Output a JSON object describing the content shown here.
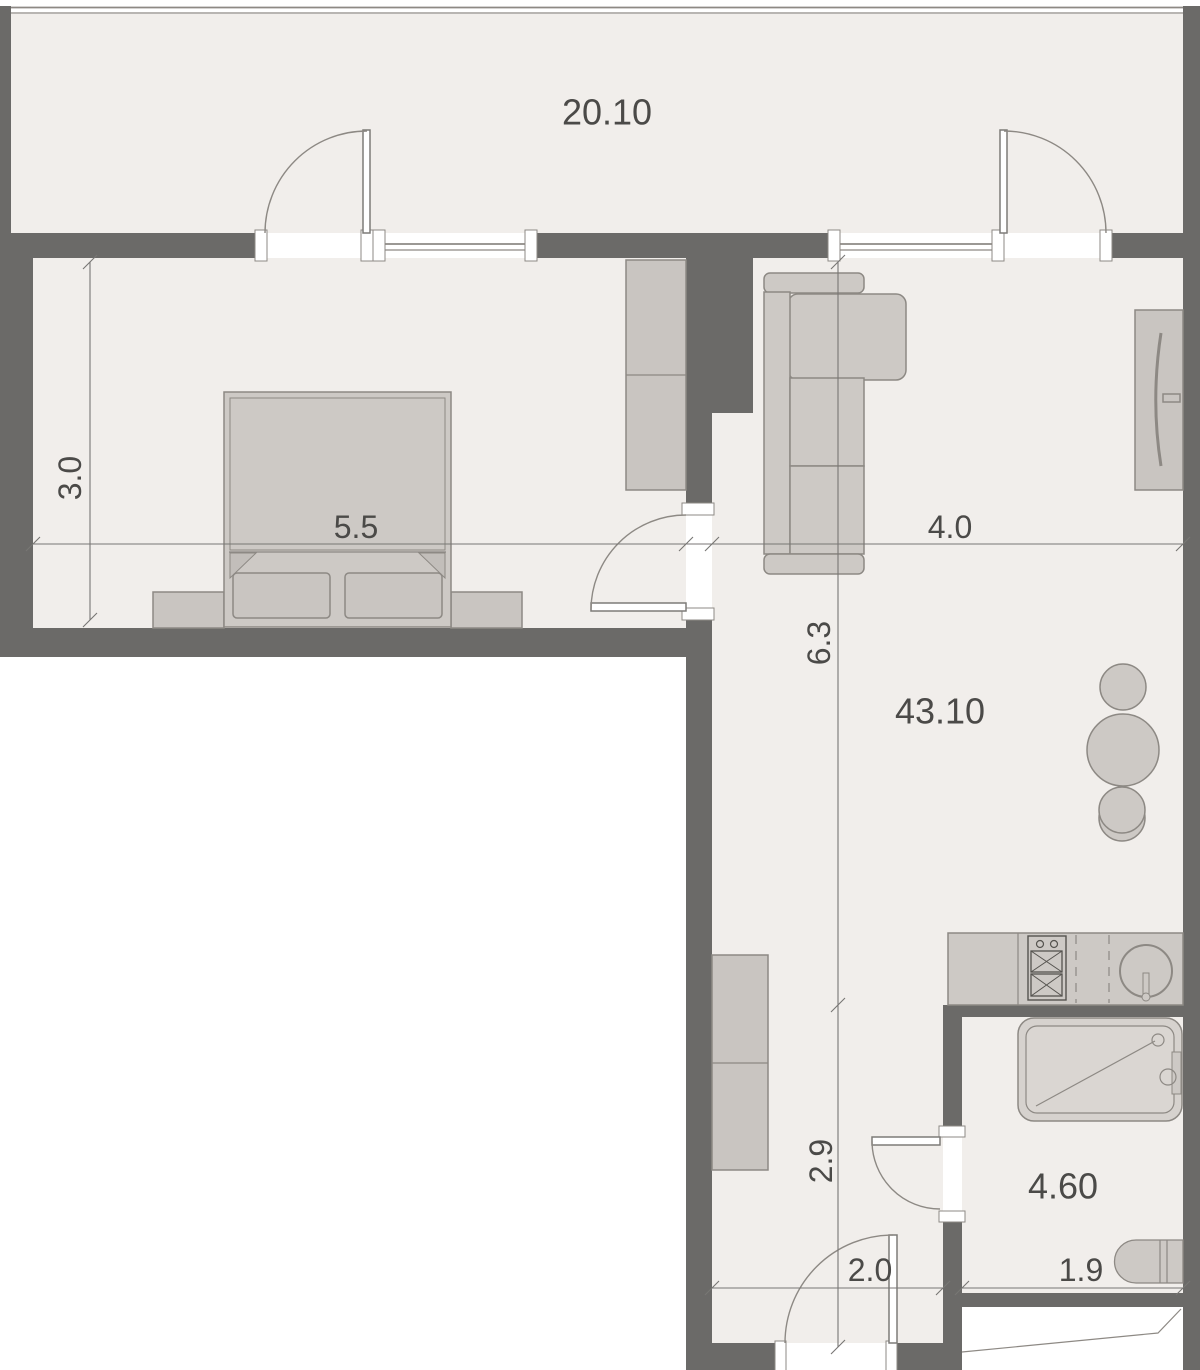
{
  "plan": {
    "title": "apartment-floor-plan",
    "rooms": {
      "balcony": {
        "area": "20.10"
      },
      "living": {
        "area": "43.10"
      },
      "bathroom": {
        "area": "4.60"
      }
    },
    "dimensions": {
      "bedroom_width": "5.5",
      "living_width": "4.0",
      "bedroom_depth": "3.0",
      "living_depth": "6.3",
      "hallway_depth": "2.9",
      "hallway_width": "2.0",
      "bathroom_width": "1.9"
    },
    "colors": {
      "wall": "#6b6a68",
      "floor": "#f1eeeb",
      "furniture": "#cdc9c5",
      "outline": "#8d8984",
      "text": "#4b4a48",
      "background": "#ffffff"
    }
  }
}
